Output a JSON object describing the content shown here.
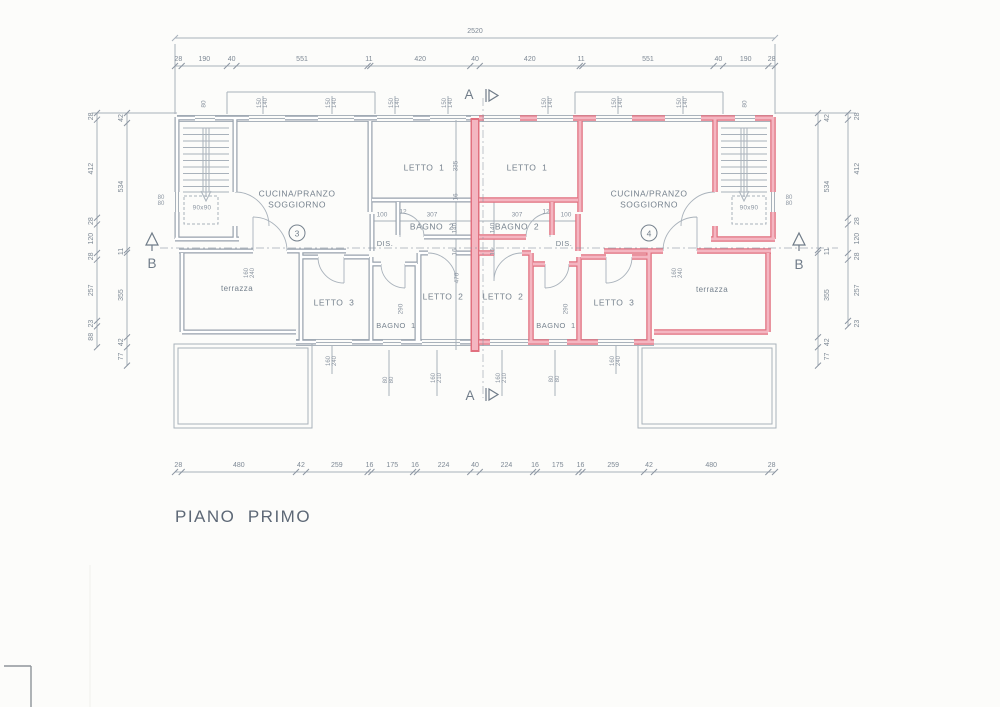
{
  "title": "PIANO  PRIMO",
  "colors": {
    "paper": "#fcfcfa",
    "line_gray": "#97a1ac",
    "line_thin": "#a9b2bb",
    "text_gray": "#76828e",
    "dim_text": "#8a94a0",
    "highlight_stroke": "#e1707f",
    "highlight_fill": "#f4b6c1"
  },
  "sections": {
    "a": "A",
    "b": "B"
  },
  "rooms": {
    "cucina3": {
      "l1": "CUCINA/PRANZO",
      "l2": "SOGGIORNO",
      "num": "3"
    },
    "cucina4": {
      "l1": "CUCINA/PRANZO",
      "l2": "SOGGIORNO",
      "num": "4"
    },
    "letto1": "LETTO  1",
    "letto2": "LETTO  2",
    "letto3": "LETTO  3",
    "bagno1": "BAGNO  1",
    "bagno2": "BAGNO  2",
    "dis": "DIS.",
    "terrazza": "terrazza",
    "stair_box": "90x90"
  },
  "dims": {
    "overall": "2520",
    "top": [
      "28",
      "190",
      "40",
      "551",
      "11",
      "420",
      "40",
      "420",
      "11",
      "551",
      "40",
      "190",
      "28"
    ],
    "bottom": [
      "28",
      "480",
      "42",
      "259",
      "16",
      "175",
      "16",
      "224",
      "40",
      "224",
      "16",
      "175",
      "16",
      "259",
      "42",
      "480",
      "28"
    ],
    "left_outer": [
      "28",
      "412",
      "28",
      "120",
      "28",
      "257",
      "23",
      "88"
    ],
    "left_inner": [
      "42",
      "534",
      "11",
      "355",
      "42",
      "77"
    ],
    "right_inner": [
      "42",
      "534",
      "11",
      "355",
      "42",
      "77"
    ],
    "right_outer": [
      "28",
      "412",
      "28",
      "120",
      "28",
      "257",
      "23"
    ],
    "small": [
      "100",
      "12",
      "307",
      "307",
      "12",
      "100",
      "335",
      "16",
      "140",
      "16",
      "470",
      "140",
      "16",
      "290",
      "290",
      "80",
      "80"
    ],
    "pairs": [
      "150\n140",
      "150\n140",
      "150\n140",
      "150\n140",
      "150\n140",
      "150\n140",
      "150\n140",
      "160\n240",
      "160\n240",
      "160\n240",
      "160\n240",
      "160\n210",
      "160\n210",
      "80\n80",
      "80\n80",
      "80\n80",
      "80\n80"
    ]
  }
}
